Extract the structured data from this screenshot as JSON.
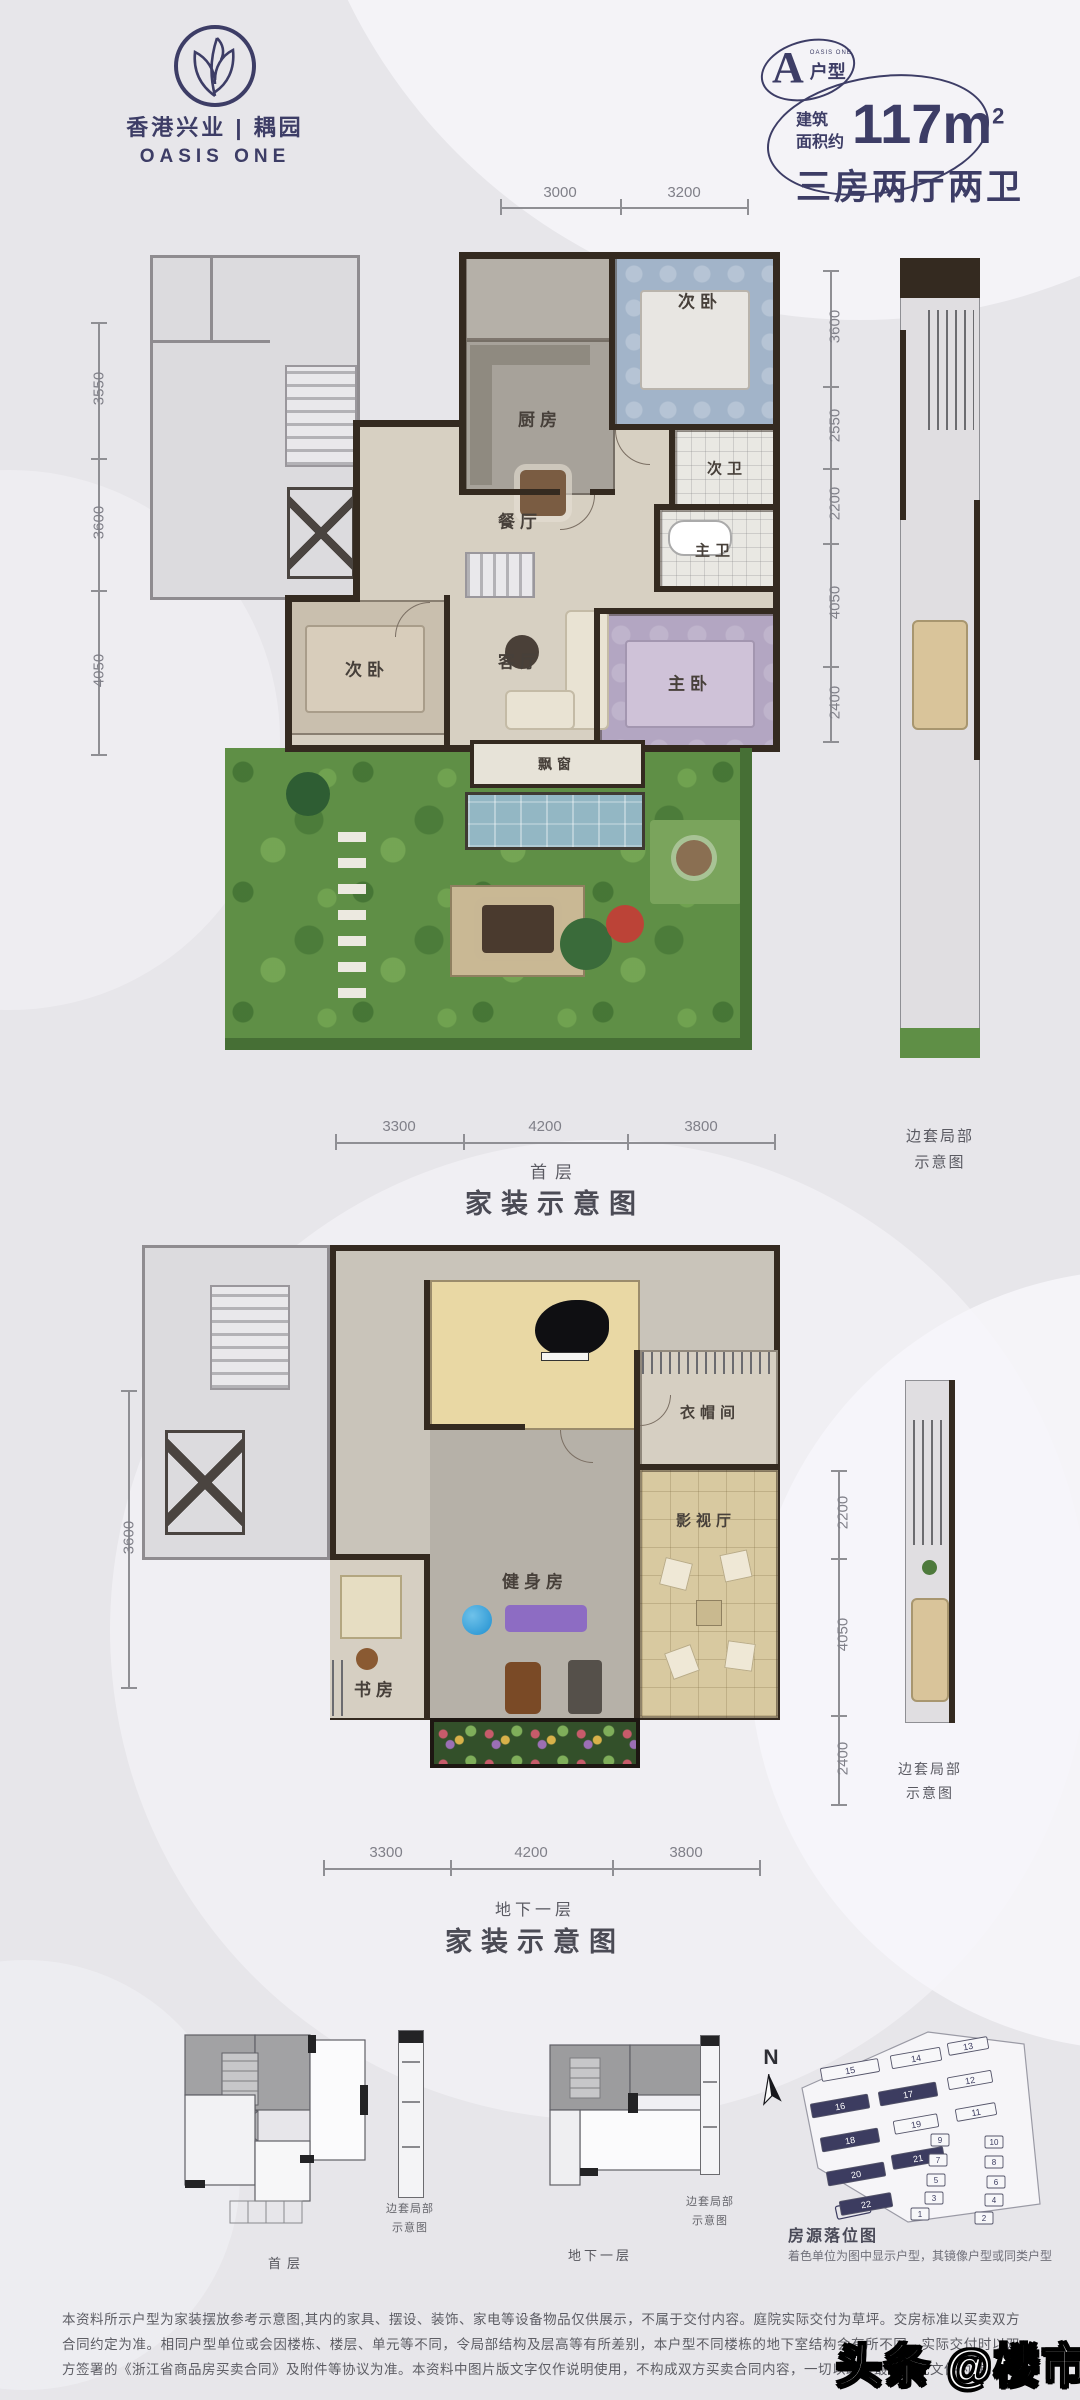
{
  "brand": {
    "cn": "香港兴业 | 耦园",
    "en": "OASIS ONE"
  },
  "badge": {
    "letter": "A",
    "type": "户型",
    "en": "OASIS ONE"
  },
  "area": {
    "prefix1": "建筑",
    "prefix2": "面积约",
    "value": "117m",
    "sup": "2",
    "rooms": "三房两厅两卫"
  },
  "plan1": {
    "floor": "首层",
    "caption": "家装示意图",
    "side1": "边套局部",
    "side2": "示意图",
    "rooms": {
      "kitchen": "厨房",
      "bedroom_top": "次卧",
      "bath2": "次卫",
      "dining": "餐厅",
      "master_bath": "主卫",
      "living": "客厅",
      "bedroom_left": "次卧",
      "master": "主卧",
      "bay": "飘窗"
    },
    "dims_top": [
      "3000",
      "3200"
    ],
    "dims_left": [
      "3550",
      "3600",
      "4050"
    ],
    "dims_right": [
      "3600",
      "2550",
      "2200",
      "4050",
      "2400"
    ],
    "dims_bottom": [
      "3300",
      "4200",
      "3800"
    ]
  },
  "plan2": {
    "floor": "地下一层",
    "caption": "家装示意图",
    "side1": "边套局部",
    "side2": "示意图",
    "rooms": {
      "closet": "衣帽间",
      "gym": "健身房",
      "media": "影视厅",
      "study": "书房"
    },
    "dims_left": [
      "3600"
    ],
    "dims_right": [
      "2200",
      "4050",
      "2400"
    ],
    "dims_bottom": [
      "3300",
      "4200",
      "3800"
    ]
  },
  "bottom": {
    "mini1_label": "首层",
    "mini2_label": "地下一层",
    "side1": "边套局部",
    "side2": "示意图",
    "compass": "N",
    "siteplan_title": "房源落位图",
    "siteplan_note": "着色单位为图中显示户型，其镜像户型或同类户型"
  },
  "siteplan": {
    "buildings": [
      {
        "no": "15",
        "dark": false
      },
      {
        "no": "14",
        "dark": false
      },
      {
        "no": "13",
        "dark": false
      },
      {
        "no": "16",
        "dark": true
      },
      {
        "no": "17",
        "dark": true
      },
      {
        "no": "12",
        "dark": false
      },
      {
        "no": "18",
        "dark": true
      },
      {
        "no": "19",
        "dark": false
      },
      {
        "no": "11",
        "dark": false
      },
      {
        "no": "20",
        "dark": true
      },
      {
        "no": "21",
        "dark": true
      },
      {
        "no": "9",
        "dark": false
      },
      {
        "no": "10",
        "dark": false
      },
      {
        "no": "7",
        "dark": false
      },
      {
        "no": "8",
        "dark": false
      },
      {
        "no": "5",
        "dark": false
      },
      {
        "no": "6",
        "dark": false
      },
      {
        "no": "3",
        "dark": false
      },
      {
        "no": "4",
        "dark": false
      },
      {
        "no": "22",
        "dark": true
      },
      {
        "no": "1",
        "dark": false
      },
      {
        "no": "2",
        "dark": false
      }
    ]
  },
  "disclaimer": "本资料所示户型为家装摆放参考示意图,其内的家具、摆设、装饰、家电等设备物品仅供展示，不属于交付内容。庭院实际交付为草坪。交房标准以买卖双方合同约定为准。相同户型单位或会因楼栋、楼层、单元等不同，令局部结构及层高等有所差别，本户型不同楼栋的地下室结构会有所不同，实际交付时以双方签署的《浙江省商品房买卖合同》及附件等协议为准。本资料中图片版文字仅作说明使用，不构成双方买卖合同内容，一切以政府最终审批文件为准。",
  "watermark": "头条 @楼市信息",
  "colors": {
    "accent": "#3d3d66",
    "wall": "#342a20",
    "garden": "#5f8f46"
  }
}
